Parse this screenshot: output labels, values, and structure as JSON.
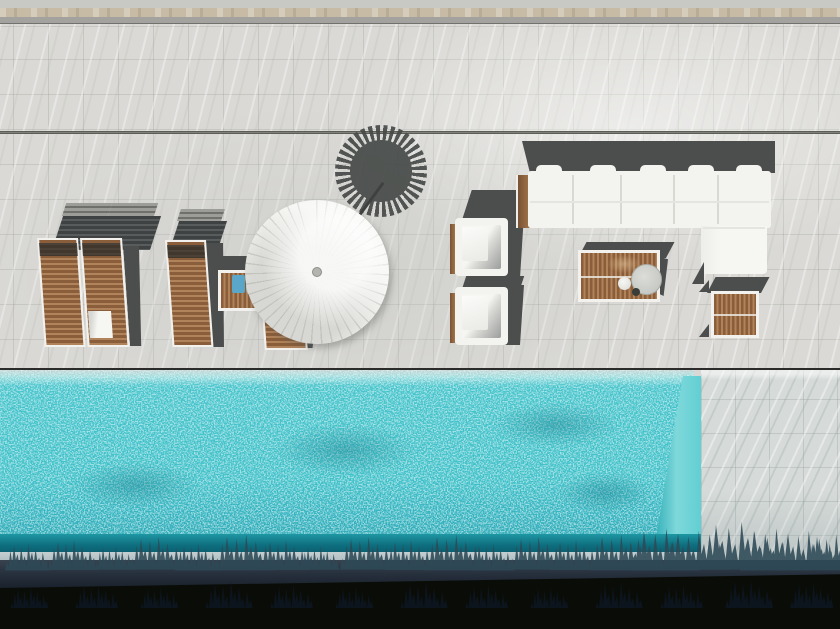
{
  "scene": {
    "description": "Aerial top-down photograph of a white marble pool terrace: four wooden sun loungers, a white fan parasol casting a round fringed shadow, two white cube armchairs, a white L-shaped sectional sofa, a slatted wood coffee table with a round tray, two slatted wood side tables, and a turquoise infinity pool edged by dark hedges below",
    "objects": [
      {
        "label": "sun-lounger",
        "count": 4,
        "material": "teak slats with white frame"
      },
      {
        "label": "towel",
        "count": 1,
        "color": "white"
      },
      {
        "label": "fan-parasol",
        "count": 1,
        "color": "white"
      },
      {
        "label": "parasol-shadow",
        "count": 1,
        "shape": "fringed disc"
      },
      {
        "label": "side-table",
        "count": 2,
        "material": "teak slats"
      },
      {
        "label": "blue-towel-item",
        "count": 1
      },
      {
        "label": "armchair",
        "count": 2,
        "color": "white"
      },
      {
        "label": "sectional-sofa",
        "count": 1,
        "color": "white",
        "shape": "L"
      },
      {
        "label": "coffee-table",
        "count": 1,
        "items": [
          "round tray",
          "white ball",
          "dark ball"
        ]
      },
      {
        "label": "infinity-pool",
        "count": 1
      },
      {
        "label": "hedge",
        "count": 1
      }
    ]
  },
  "palette": {
    "marble": "#dad9d5",
    "marble_wall": "#d6dbd9",
    "beige_trim": "#c7bba5",
    "trim_gray": "#a3a29f",
    "wood_dark": "#8a5e3a",
    "wood_light": "#b1835a",
    "frame_white": "#f2f1ed",
    "shadow_dark": "#4b4e4d",
    "cushion_white": "#f3f3f0",
    "pool": "#46c3cb",
    "spill_band": "#c4cfd1",
    "plant_shadow": "#2e4a57",
    "ledge": "#252e3b",
    "hedge": "#0a0d07",
    "umbrella_white": "#f4f4f1",
    "umbrella_shadow": "#464a48",
    "towel_blue": "#5ba7c9",
    "plate_gray": "#c6c8c3"
  }
}
